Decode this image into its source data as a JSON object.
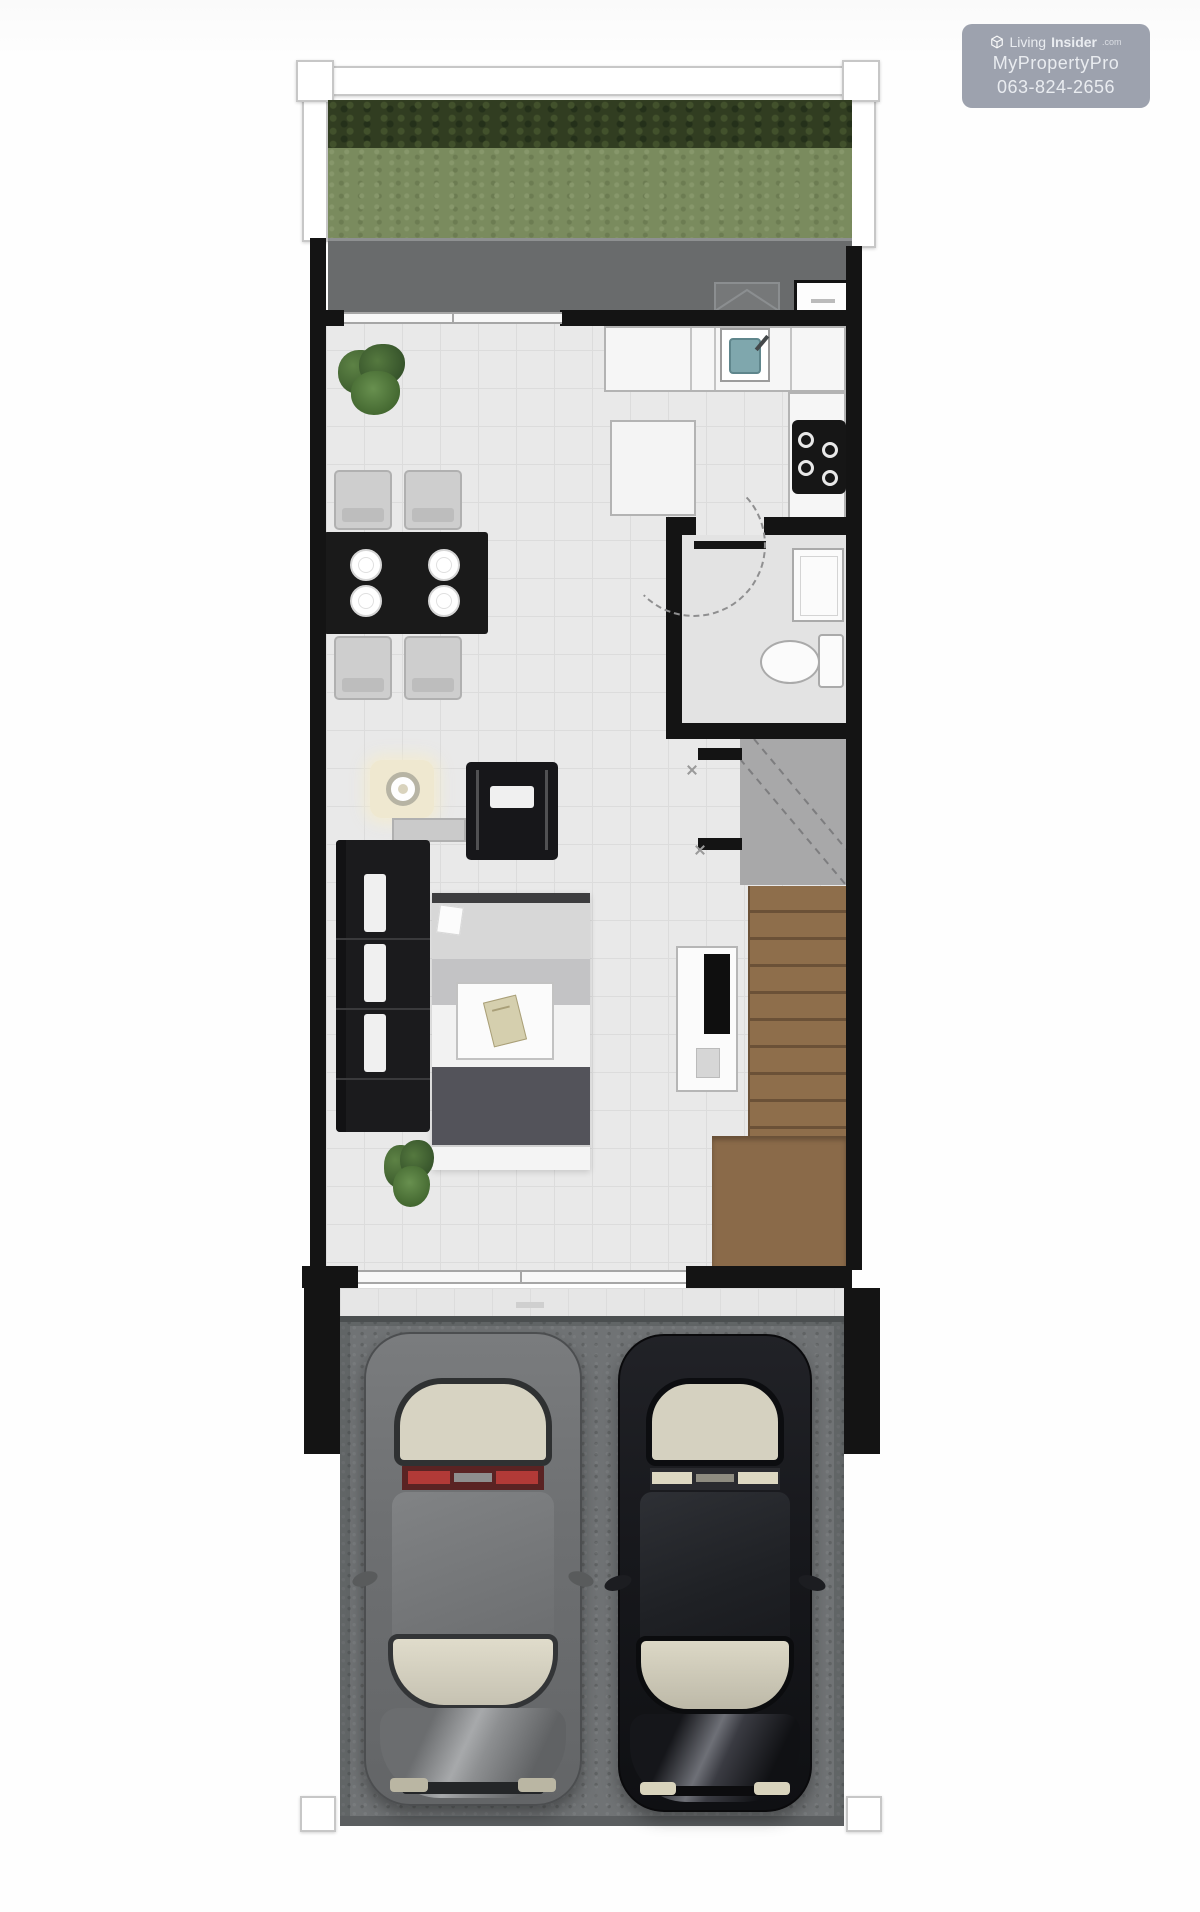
{
  "watermark": {
    "brand_prefix": "Living",
    "brand_bold": "Insider",
    "brand_suffix": ".com",
    "line2": "MyPropertyPro",
    "line3": "063-824-2656",
    "bg": "rgba(150,155,168,0.93)"
  },
  "palette": {
    "wall": "#141414",
    "floor": "#e9e9e9",
    "floor_grid": "#dcdcdc",
    "terrace": "#696b6c",
    "hedge": "#313d21",
    "grass": "#7a8b5e",
    "stairs": "#8e6e4b",
    "stairs_line": "#6b5137",
    "garage": "#707375",
    "sink_basin": "#7fa7ad",
    "tail_light": "#b23a37",
    "sofa": "#1b1b1d",
    "rug_dark": "#53535a",
    "plant": "#4d7239"
  }
}
